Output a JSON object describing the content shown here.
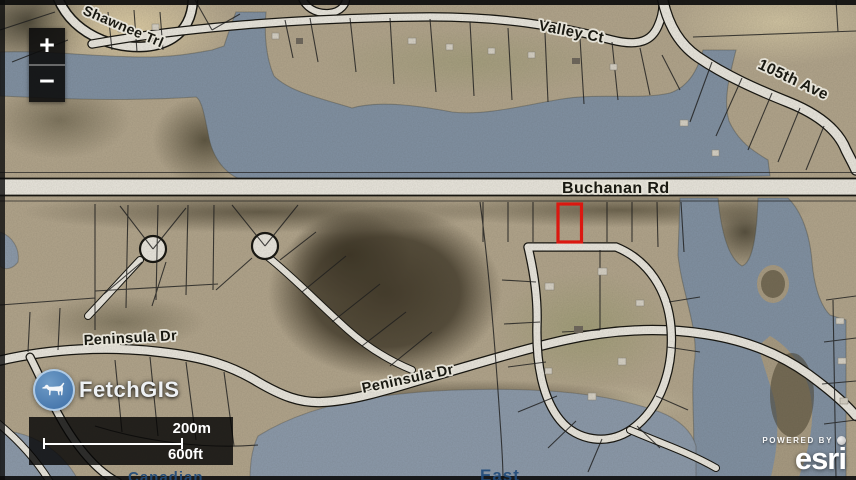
{
  "map": {
    "road_labels": {
      "shawnee_trl": "Shawnee Trl",
      "valley_ct": "Valley Ct",
      "ave_105th": "105th Ave",
      "buchanan_rd": "Buchanan Rd",
      "peninsula_dr_west": "Peninsula Dr",
      "peninsula_dr_center": "Peninsula Dr"
    },
    "water_labels": {
      "canadian": "Canadian",
      "east": "East"
    },
    "colors": {
      "water": "#8191a3",
      "land": "#b2a58c",
      "road": "#ebe8df",
      "parcel_line": "#1c1c1c",
      "highlight": "#e8150e",
      "logo_blue": "#4878ad",
      "label_water_text": "#1f4a7a"
    }
  },
  "controls": {
    "zoom_in_label": "+",
    "zoom_out_label": "−"
  },
  "logo": {
    "name": "FetchGIS"
  },
  "scale_bar": {
    "metric": "200m",
    "imperial": "600ft"
  },
  "attribution": {
    "powered_by": "POWERED BY",
    "brand": "esri"
  }
}
